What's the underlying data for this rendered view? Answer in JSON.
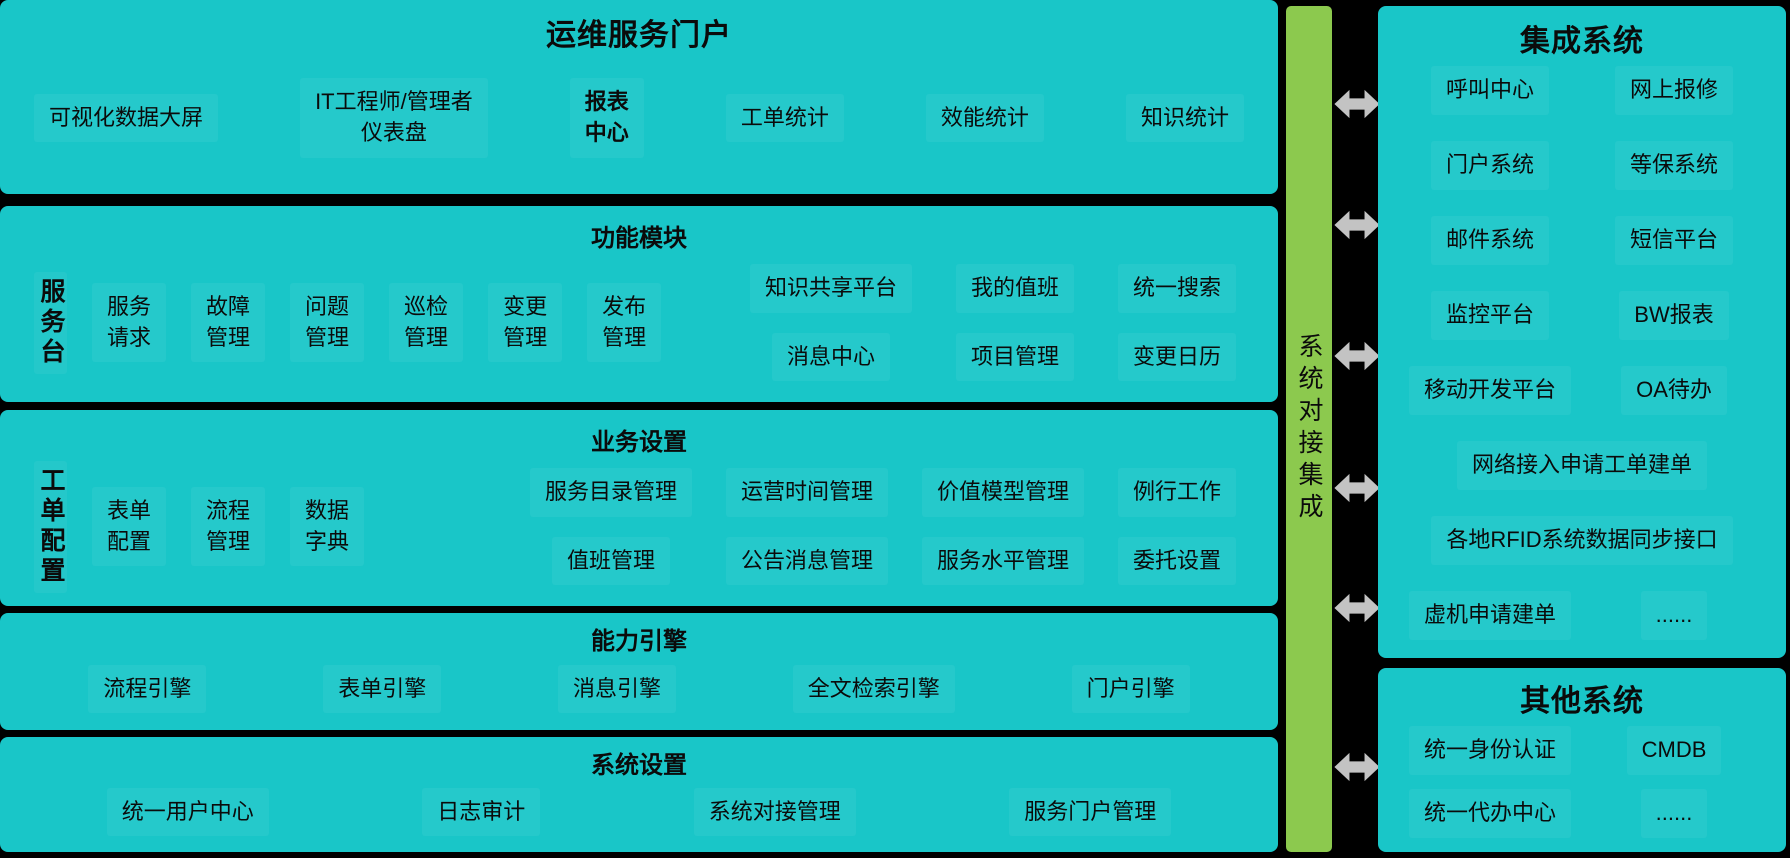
{
  "colors": {
    "teal": "#19c6c8",
    "green": "#8cc94e",
    "arrow": "#c3c3c3",
    "text": "#0b0b0b",
    "background": "#000000"
  },
  "portal": {
    "title": "运维服务门户",
    "top_items": [
      "可视化数据大屏",
      "IT工程师/管理者\n仪表盘",
      "报表\n中心",
      "工单统计",
      "效能统计",
      "知识统计"
    ],
    "modules": {
      "title": "功能模块",
      "side_label": "服务台",
      "items": [
        "服务\n请求",
        "故障\n管理",
        "问题\n管理",
        "巡检\n管理",
        "变更\n管理",
        "发布\n管理"
      ],
      "grid": [
        "知识共享平台",
        "我的值班",
        "统一搜索",
        "消息中心",
        "项目管理",
        "变更日历"
      ]
    },
    "business": {
      "title": "业务设置",
      "side_label": "工单配置",
      "items": [
        "表单\n配置",
        "流程\n管理",
        "数据\n字典"
      ],
      "grid": [
        "服务目录管理",
        "运营时间管理",
        "价值模型管理",
        "例行工作",
        "值班管理",
        "公告消息管理",
        "服务水平管理",
        "委托设置"
      ]
    },
    "engines": {
      "title": "能力引擎",
      "items": [
        "流程引擎",
        "表单引擎",
        "消息引擎",
        "全文检索引擎",
        "门户引擎"
      ]
    },
    "system": {
      "title": "系统设置",
      "items": [
        "统一用户中心",
        "日志审计",
        "系统对接管理",
        "服务门户管理"
      ]
    }
  },
  "connector": {
    "label": "系统对接集成",
    "arrow_count": 6
  },
  "integration": {
    "title": "集成系统",
    "pairs": [
      [
        "呼叫中心",
        "网上报修"
      ],
      [
        "门户系统",
        "等保系统"
      ],
      [
        "邮件系统",
        "短信平台"
      ],
      [
        "监控平台",
        "BW报表"
      ],
      [
        "移动开发平台",
        "OA待办"
      ]
    ],
    "wide_items": [
      "网络接入申请工单建单",
      "各地RFID系统数据同步接口"
    ],
    "last_pair": [
      "虚机申请建单",
      "......"
    ]
  },
  "others": {
    "title": "其他系统",
    "pairs": [
      [
        "统一身份认证",
        "CMDB"
      ],
      [
        "统一代办中心",
        "......"
      ]
    ]
  }
}
